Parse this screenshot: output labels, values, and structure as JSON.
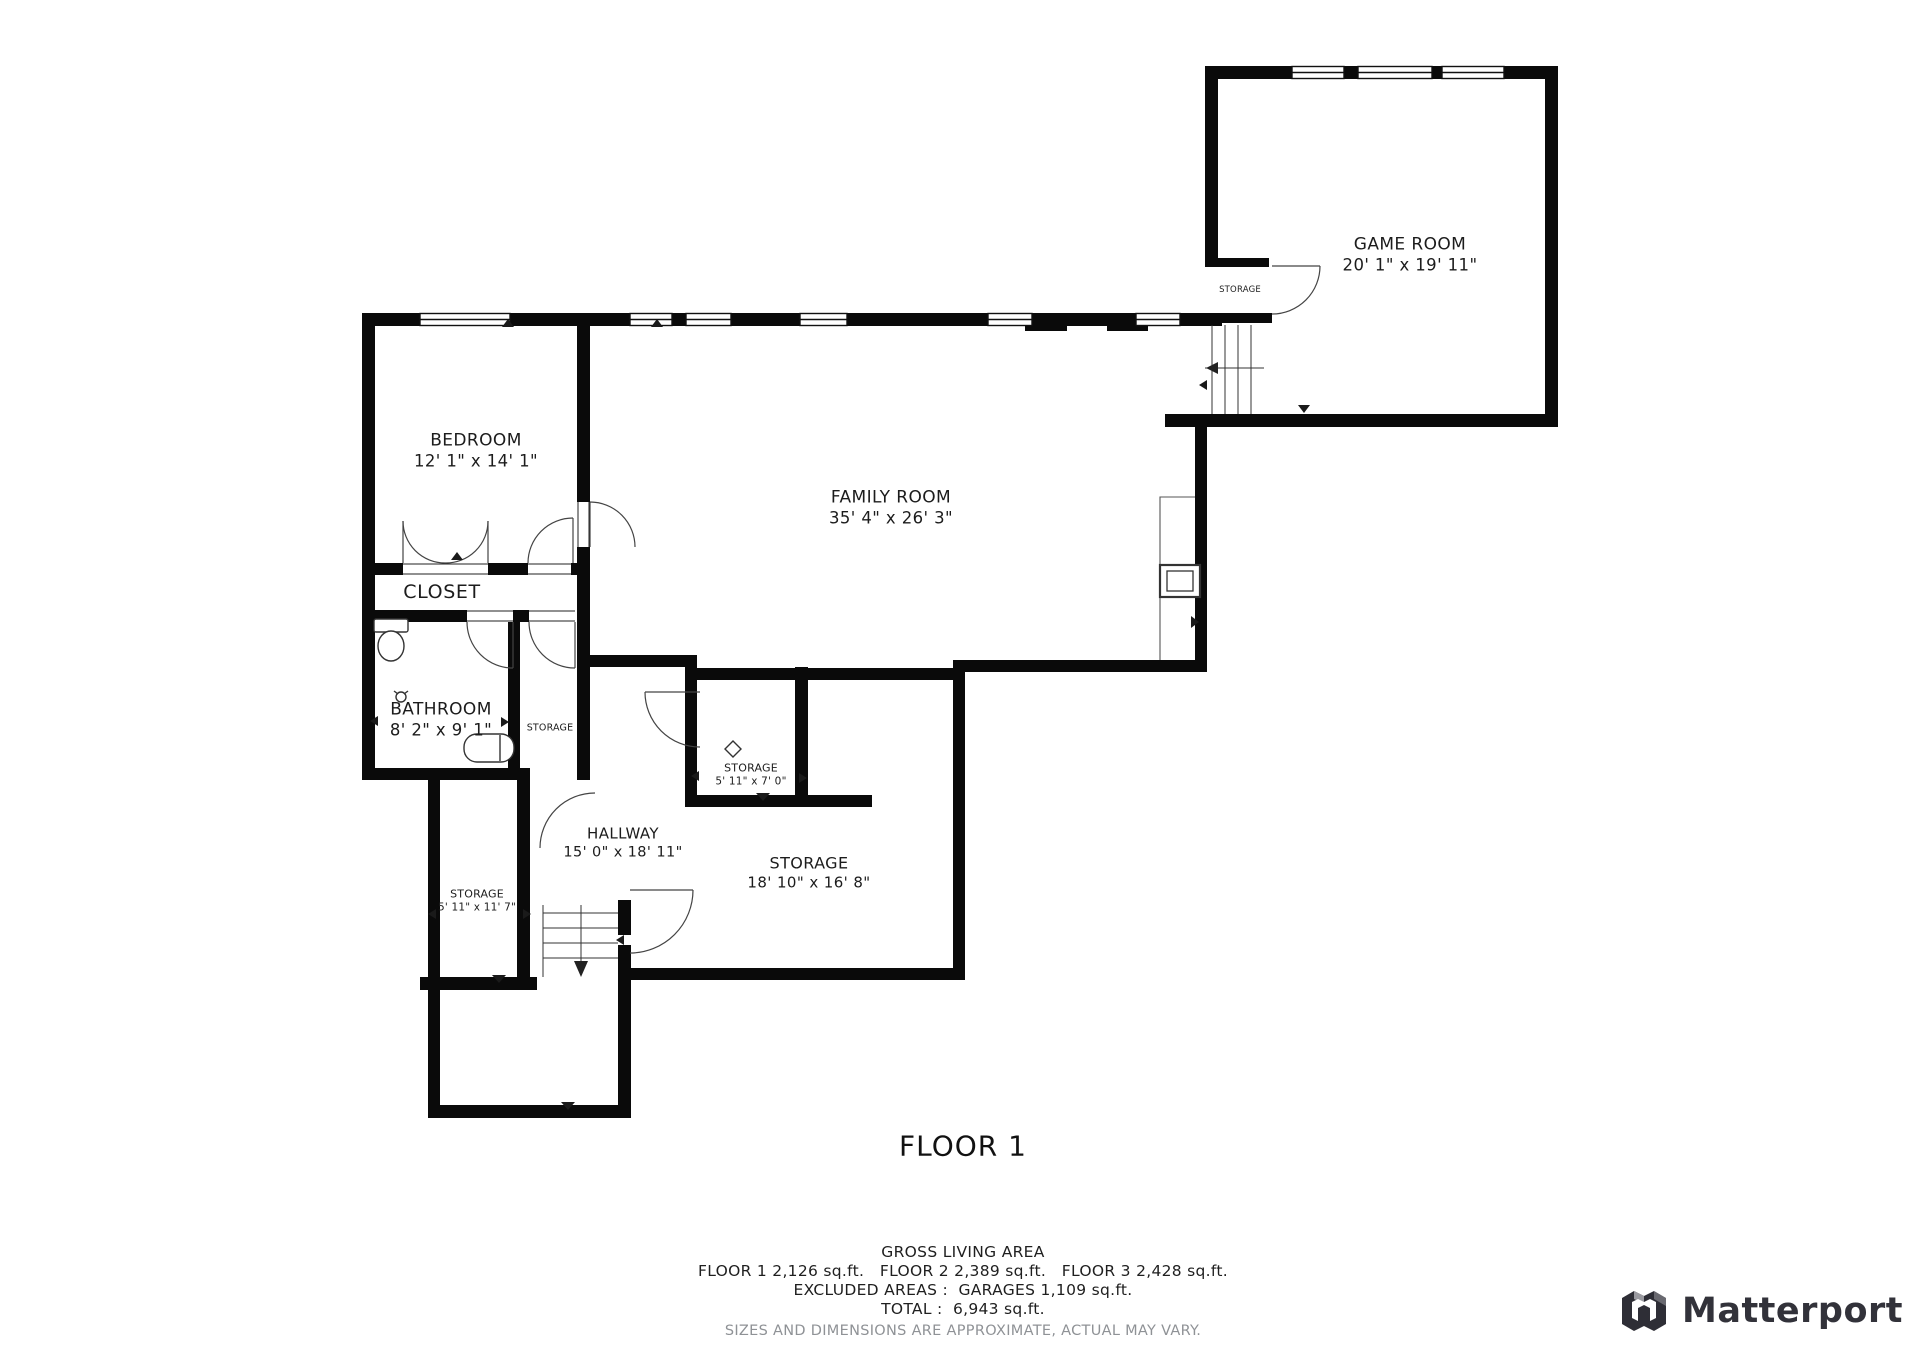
{
  "floor_plan": {
    "title": "FLOOR 1",
    "rooms": {
      "game_room": {
        "name": "GAME ROOM",
        "dims": "20' 1\" x 19' 11\""
      },
      "bedroom": {
        "name": "BEDROOM",
        "dims": "12' 1\" x 14' 1\""
      },
      "family_room": {
        "name": "FAMILY ROOM",
        "dims": "35' 4\" x 26' 3\""
      },
      "closet": {
        "name": "CLOSET"
      },
      "bathroom": {
        "name": "BATHROOM",
        "dims": "8' 2\" x 9' 1\""
      },
      "storage_bath": {
        "name": "STORAGE"
      },
      "storage_gamebox": {
        "name": "STORAGE"
      },
      "storage_hall": {
        "name": "STORAGE",
        "dims": "5' 11\" x 7' 0\""
      },
      "hallway": {
        "name": "HALLWAY",
        "dims": "15' 0\" x 18' 11\""
      },
      "storage_main": {
        "name": "STORAGE",
        "dims": "18' 10\" x 16' 8\""
      },
      "storage_left": {
        "name": "STORAGE",
        "dims": "5' 11\" x 11' 7\""
      }
    },
    "summary": {
      "heading": "GROSS LIVING AREA",
      "floors_line": "FLOOR 1 2,126 sq.ft.   FLOOR 2 2,389 sq.ft.   FLOOR 3 2,428 sq.ft.",
      "excluded_line": "EXCLUDED AREAS :  GARAGES 1,109 sq.ft.",
      "total_line": "TOTAL :  6,943 sq.ft.",
      "disclaimer": "SIZES AND DIMENSIONS ARE APPROXIMATE, ACTUAL MAY VARY."
    },
    "branding": {
      "logo_text": "Matterport"
    },
    "colors": {
      "wall": "#0a0a0a",
      "label": "#1c1c1c",
      "disclaimer": "#8f9296",
      "logo": "#32323a"
    }
  }
}
